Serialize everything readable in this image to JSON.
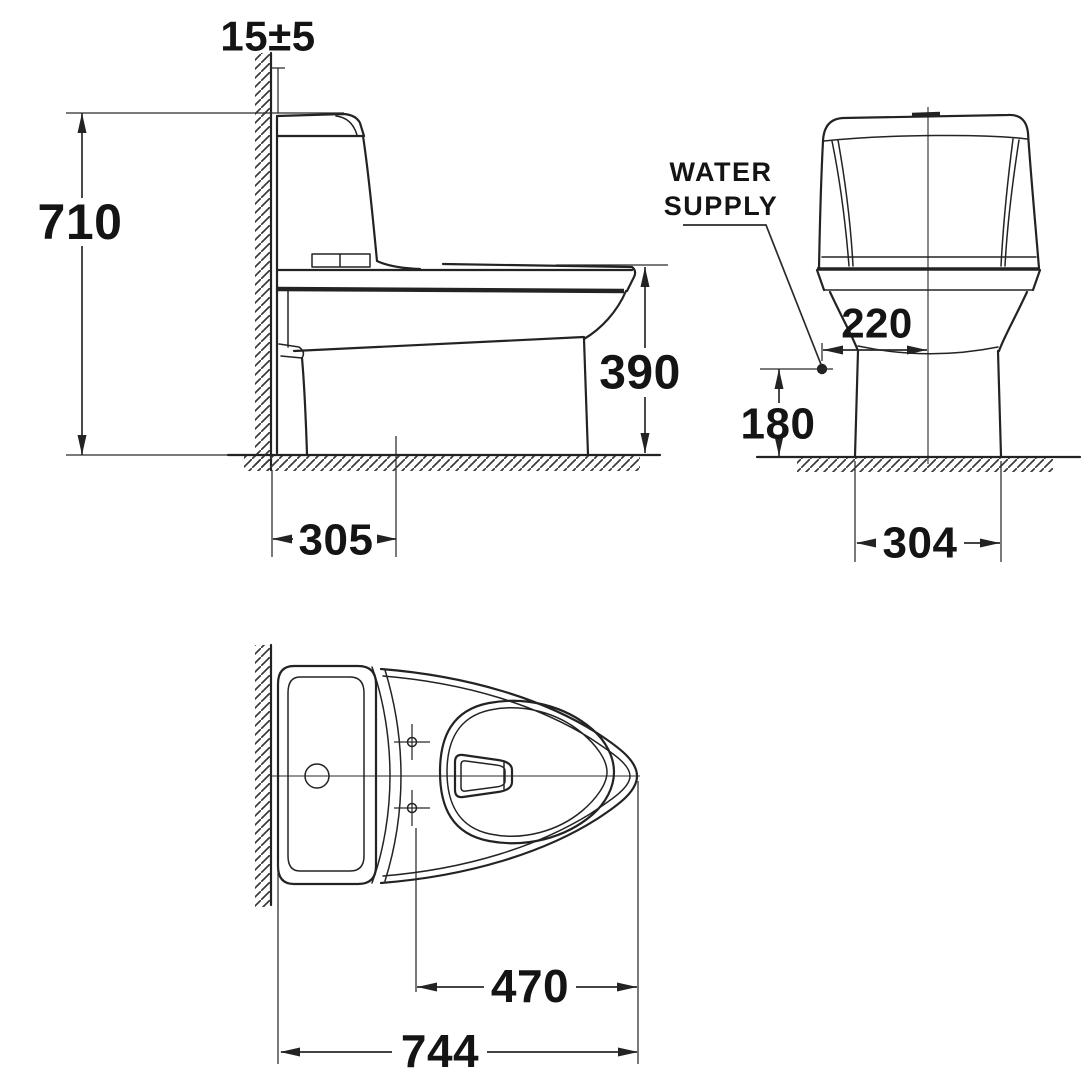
{
  "colors": {
    "ink": "#232323",
    "label": "#141414",
    "background": "#ffffff"
  },
  "views": {
    "side": {
      "wall_gap": "15±5",
      "overall_height": "710",
      "rim_height": "390",
      "outlet_from_wall": "305"
    },
    "front": {
      "water_supply_line1": "WATER",
      "water_supply_line2": "SUPPLY",
      "supply_to_center": "220",
      "supply_height": "180",
      "base_width": "304"
    },
    "top": {
      "bolts_to_front": "470",
      "overall_depth": "744"
    }
  }
}
